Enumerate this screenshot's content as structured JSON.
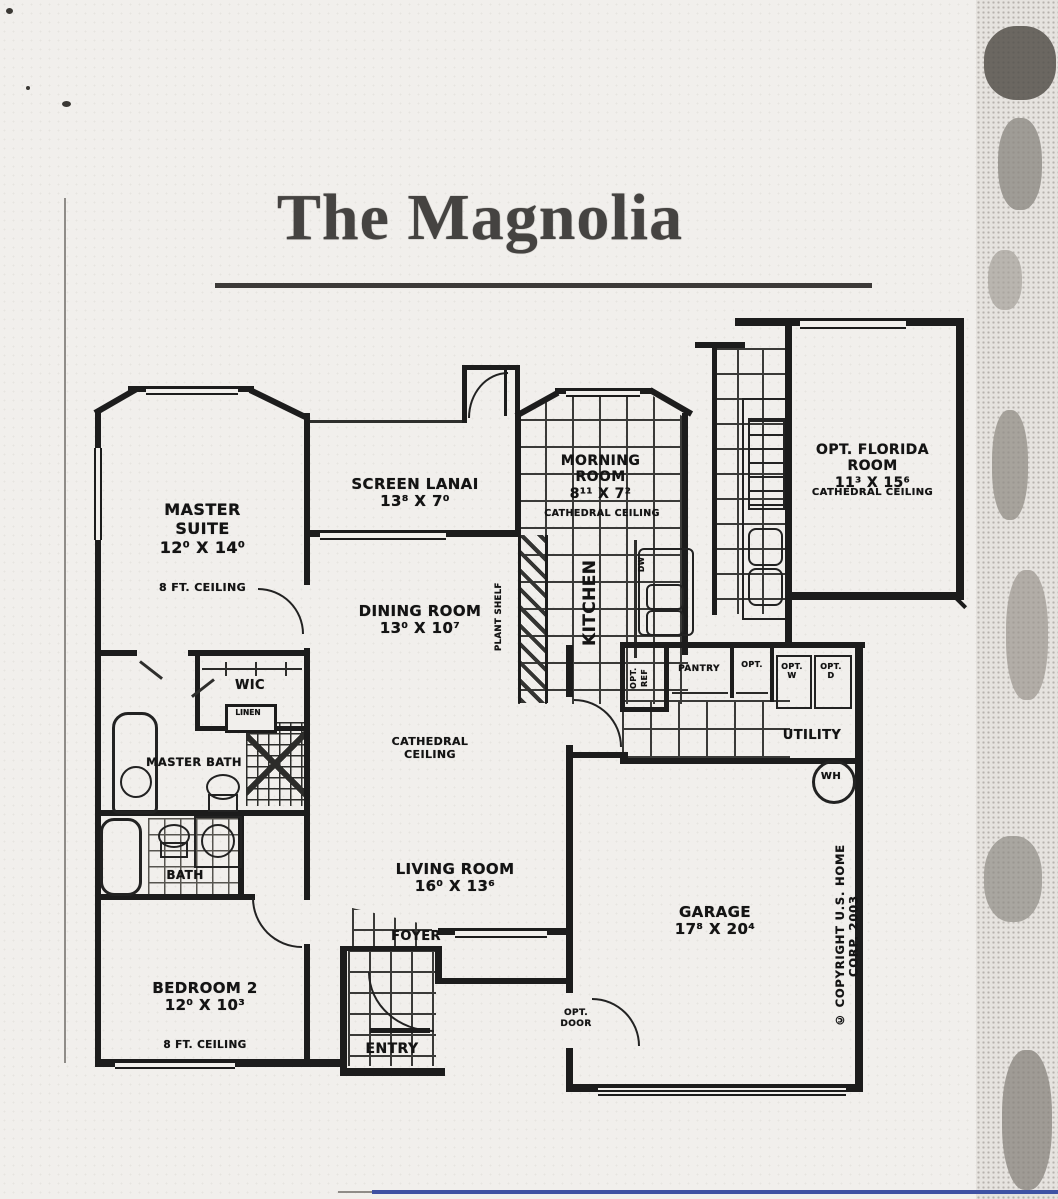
{
  "title": "The Magnolia",
  "rooms": {
    "master_suite": {
      "name": "MASTER\nSUITE",
      "dims": "12⁰ X 14⁰",
      "ceiling": "8 FT. CEILING"
    },
    "screen_lanai": {
      "name": "SCREEN LANAI",
      "dims": "13⁸ X 7⁰"
    },
    "morning_room": {
      "name": "MORNING\nROOM",
      "dims": "8¹¹ X 7²",
      "ceiling": "CATHEDRAL CEILING"
    },
    "florida_room": {
      "name": "OPT. FLORIDA\nROOM",
      "dims": "11³ X 15⁶",
      "ceiling": "CATHEDRAL CEILING"
    },
    "dining_room": {
      "name": "DINING ROOM",
      "dims": "13⁰ X 10⁷"
    },
    "kitchen": {
      "name": "KITCHEN"
    },
    "living_room": {
      "name": "LIVING ROOM",
      "dims": "16⁰ X 13⁶",
      "ceiling": "CATHEDRAL CEILING"
    },
    "bedroom_2": {
      "name": "BEDROOM 2",
      "dims": "12⁰ X 10³",
      "ceiling": "8 FT. CEILING"
    },
    "garage": {
      "name": "GARAGE",
      "dims": "17⁸ X 20⁴"
    },
    "master_bath": {
      "name": "MASTER BATH"
    },
    "bath": {
      "name": "BATH"
    },
    "wic": {
      "name": "WIC"
    },
    "foyer": {
      "name": "FOYER"
    },
    "entry": {
      "name": "ENTRY"
    },
    "utility": {
      "name": "UTILITY"
    }
  },
  "fixtures": {
    "plant_shelf": "PLANT SHELF",
    "linen": "LINEN",
    "dishwasher": "DW",
    "opt_ref": "OPT.\nREF",
    "pantry": "PANTRY",
    "opt_closet": "OPT.",
    "opt_washer": "OPT.\nW",
    "opt_dryer": "OPT.\nD",
    "water_heater": "WH",
    "opt_door": "OPT.\nDOOR"
  },
  "footer": {
    "copyright": "© COPYRIGHT U.S. HOME CORP. 2003"
  }
}
